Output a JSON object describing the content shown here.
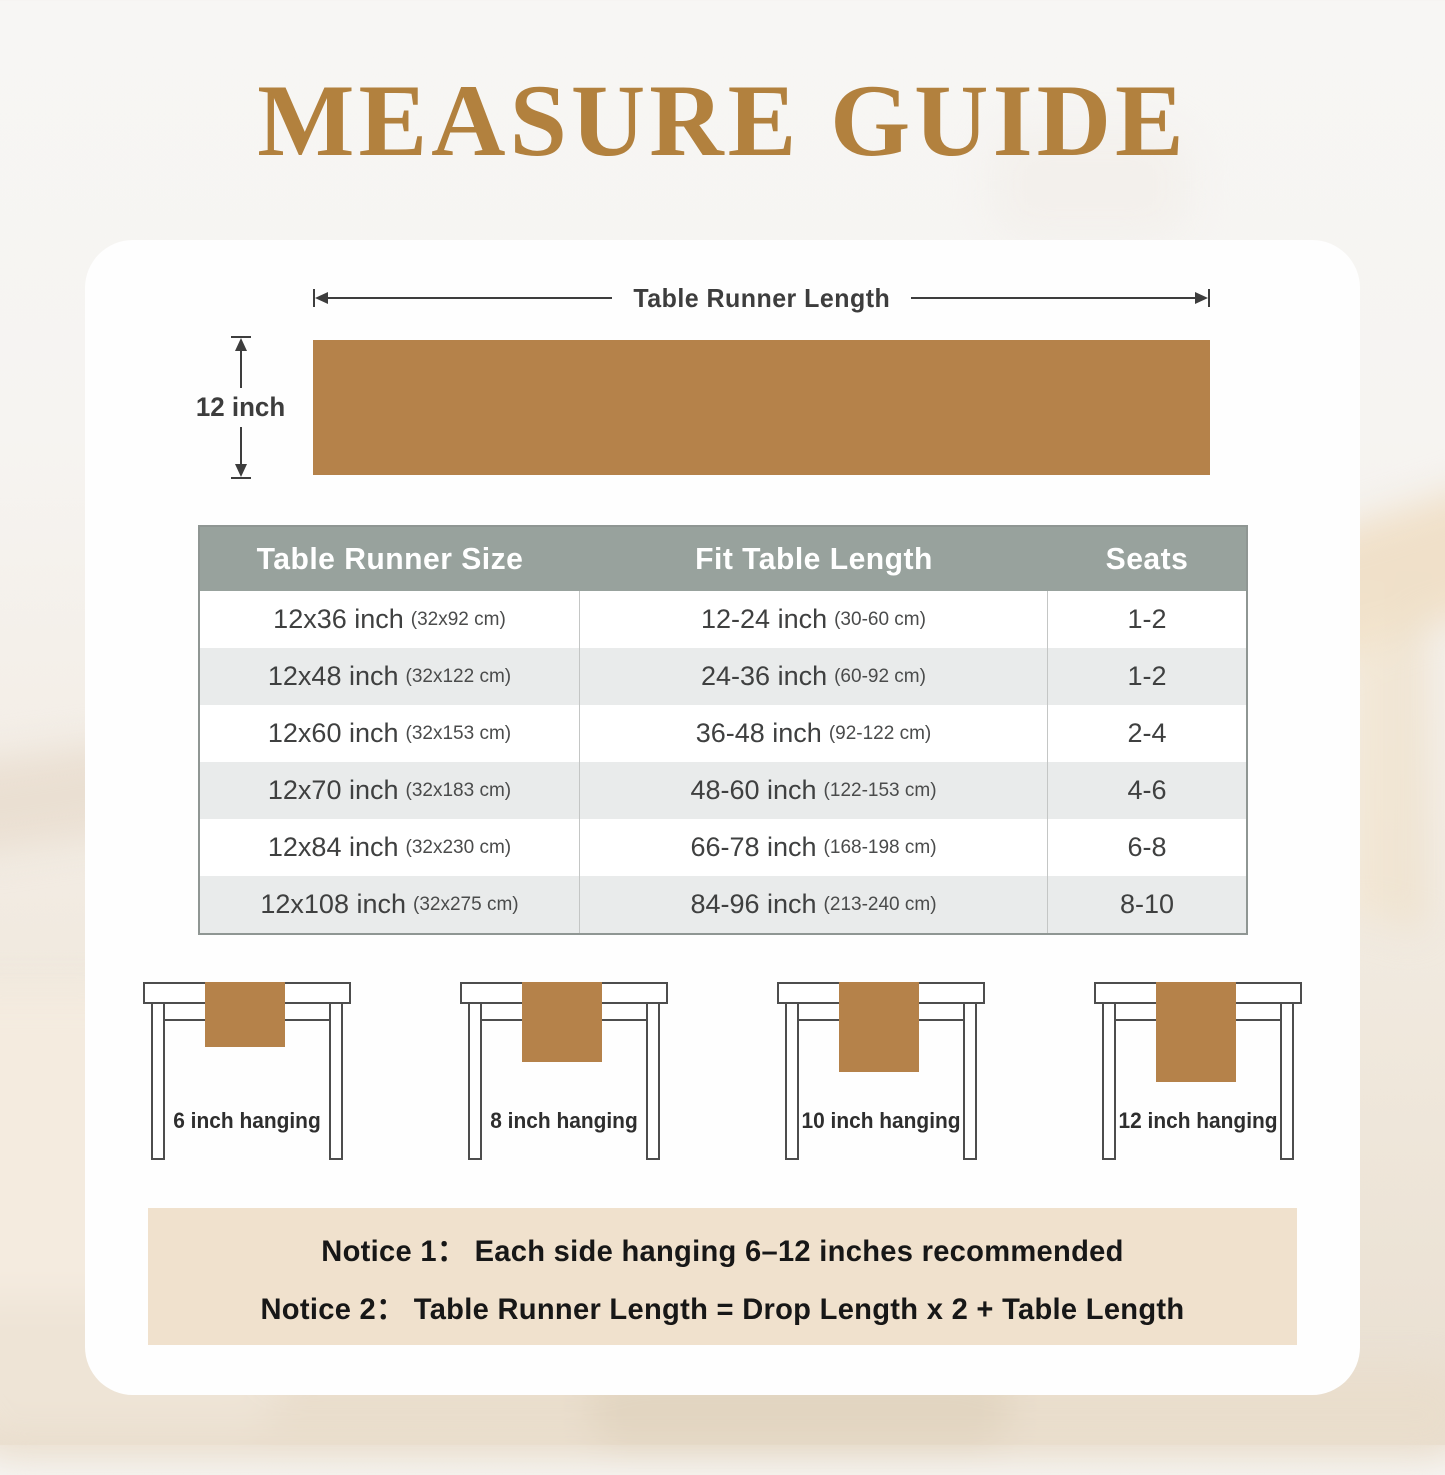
{
  "title": "MEASURE GUIDE",
  "colors": {
    "title_brown": "#b2813e",
    "runner_brown": "#b5824a",
    "table_header_bg": "#98a29d",
    "table_alt_row": "#e9ebeb",
    "notice_bg": "#f0e1cd",
    "line_dark": "#3d3d3d"
  },
  "diagram": {
    "length_label": "Table Runner Length",
    "height_label": "12 inch"
  },
  "size_table": {
    "headers": [
      "Table Runner Size",
      "Fit Table Length",
      "Seats"
    ],
    "rows": [
      {
        "size": "12x36 inch",
        "size_cm": "(32x92 cm)",
        "fit": "12-24 inch",
        "fit_cm": "(30-60 cm)",
        "seats": "1-2"
      },
      {
        "size": "12x48 inch",
        "size_cm": "(32x122 cm)",
        "fit": "24-36 inch",
        "fit_cm": "(60-92 cm)",
        "seats": "1-2"
      },
      {
        "size": "12x60 inch",
        "size_cm": "(32x153 cm)",
        "fit": "36-48 inch",
        "fit_cm": "(92-122 cm)",
        "seats": "2-4"
      },
      {
        "size": "12x70 inch",
        "size_cm": "(32x183 cm)",
        "fit": "48-60 inch",
        "fit_cm": "(122-153 cm)",
        "seats": "4-6"
      },
      {
        "size": "12x84 inch",
        "size_cm": "(32x230 cm)",
        "fit": "66-78 inch",
        "fit_cm": "(168-198 cm)",
        "seats": "6-8"
      },
      {
        "size": "12x108 inch",
        "size_cm": "(32x275 cm)",
        "fit": "84-96 inch",
        "fit_cm": "(213-240 cm)",
        "seats": "8-10"
      }
    ]
  },
  "hanging_examples": [
    {
      "label": "6 inch hanging"
    },
    {
      "label": "8 inch hanging"
    },
    {
      "label": "10 inch hanging"
    },
    {
      "label": "12 inch hanging"
    }
  ],
  "notices": {
    "line1": "Notice 1：  Each side hanging 6–12 inches recommended",
    "line2": "Notice 2：  Table Runner Length = Drop Length x 2 + Table Length"
  }
}
